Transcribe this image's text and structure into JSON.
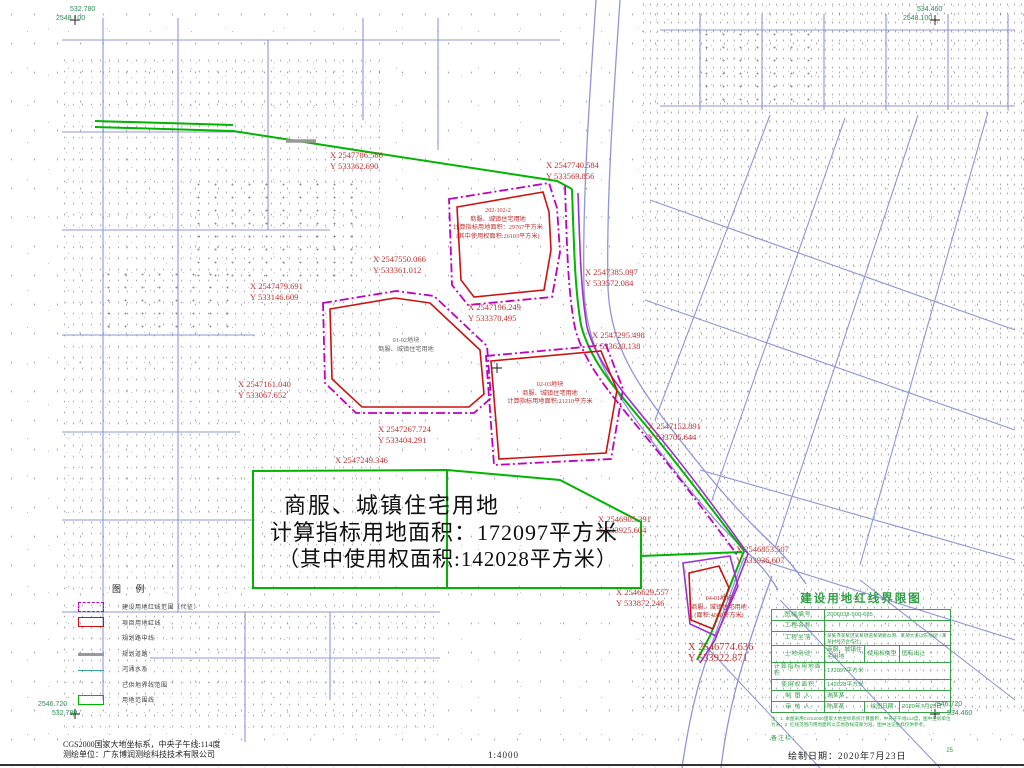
{
  "map": {
    "main_annotation": {
      "line1": "商服、城镇住宅用地",
      "line2": "计算指标用地面积：172097平方米",
      "line3": "（其中使用权面积:142028平方米）"
    },
    "corner_coords": {
      "top_left": {
        "line1": "532.780",
        "line2": "2548.100"
      },
      "top_right": {
        "line1": "534.460",
        "line2": "2548.100"
      },
      "bottom_left": {
        "line1": "2546.720",
        "line2": "532.780"
      },
      "bottom_right": {
        "line1": "2546.720",
        "line2": "534.460"
      }
    },
    "coordinate_labels": [
      {
        "x": 330,
        "y": 150,
        "l1": "X 2547786.566",
        "l2": "Y 533362.690"
      },
      {
        "x": 546,
        "y": 160,
        "l1": "X 2547740.584",
        "l2": "Y 533569.856"
      },
      {
        "x": 373,
        "y": 254,
        "l1": "X 2547550.066",
        "l2": "Y 533361.012"
      },
      {
        "x": 250,
        "y": 281,
        "l1": "X 2547479.691",
        "l2": "Y 533146.609"
      },
      {
        "x": 468,
        "y": 302,
        "l1": "X 2547196.249",
        "l2": "Y 533370.495"
      },
      {
        "x": 585,
        "y": 267,
        "l1": "X 2547385.097",
        "l2": "Y 533572.084"
      },
      {
        "x": 592,
        "y": 330,
        "l1": "X 2547295.498",
        "l2": "Y 533620.138"
      },
      {
        "x": 238,
        "y": 379,
        "l1": "X 2547161.040",
        "l2": "Y 533067.652"
      },
      {
        "x": 378,
        "y": 424,
        "l1": "X 2547267.724",
        "l2": "Y 533404.291"
      },
      {
        "x": 335,
        "y": 455,
        "l1": "X 2547249.346"
      },
      {
        "x": 648,
        "y": 421,
        "l1": "X 2547152.891",
        "l2": "Y 533705.644"
      },
      {
        "x": 598,
        "y": 514,
        "l1": "X 2546905.391",
        "l2": "Y 533925.604"
      },
      {
        "x": 736,
        "y": 544,
        "l1": "X 2546853.507",
        "l2": "Y 533936.607"
      },
      {
        "x": 616,
        "y": 587,
        "l1": "X 2546629.557",
        "l2": "Y 533872.246"
      },
      {
        "x": 688,
        "y": 642,
        "l1": "X 2546774.636",
        "l2": "Y 533922.871",
        "size": 10.5
      }
    ],
    "parcel_texts": [
      {
        "x": 436,
        "y": 207,
        "w": 124,
        "lines": [
          "202-102-2",
          "商服、城镇住宅用地",
          "计算指标用地面积：29767平方米",
          "(其中使用权面积:26103平方米)"
        ]
      },
      {
        "x": 494,
        "y": 381,
        "w": 112,
        "lines": [
          "02-03地块",
          "商服、城镇住宅用地",
          "计算指标用地面积:21210平方米"
        ]
      },
      {
        "x": 360,
        "y": 337,
        "w": 92,
        "muted": true,
        "lines": [
          "01-02地块",
          "商服、城镇住宅用地"
        ]
      },
      {
        "x": 682,
        "y": 595,
        "w": 74,
        "lines": [
          "04-01地块",
          "商服、城镇住宅用地",
          "(面积:4060平方米)"
        ]
      }
    ]
  },
  "legend": {
    "title": "图 例",
    "items": [
      {
        "swatch": "magenta-dashed-rect",
        "label": "建设用地红线范围（代征）"
      },
      {
        "swatch": "red-rect",
        "label": "项目用地红线"
      },
      {
        "swatch": "none",
        "label": "规划路中线"
      },
      {
        "swatch": "gray-line",
        "label": "规划道路"
      },
      {
        "swatch": "teal-line",
        "label": "河涌水系"
      },
      {
        "swatch": "none",
        "label": "已供地界线范围"
      },
      {
        "swatch": "green-rect",
        "label": "用地范围线"
      }
    ]
  },
  "title_block": {
    "title": "建设用地红线界限图",
    "rows": [
      {
        "label": "图幅编号",
        "value": "2006038-500-685"
      },
      {
        "label": "工程名称",
        "value": ""
      },
      {
        "label": "工程坐落",
        "value": "某某市某某区某某街道某某路以南、某某大道以东地段（某某村经济合作社）"
      },
      {
        "label": "土地用途",
        "value": "商服、城镇住宅用地",
        "label2": "使用权类型",
        "value2": "国有出让"
      },
      {
        "label": "计算指标用地面积",
        "value": "172097平方米"
      },
      {
        "label": "使用权面积",
        "value": "142028平方米"
      },
      {
        "label": "制 图 人",
        "value": "谢某某"
      },
      {
        "label": "审 核 人",
        "value": "陈某某",
        "label2": "绘图日期",
        "value2": "2020年7月23日"
      }
    ],
    "notes": "注：1. 本图采用CGS2000国家大地坐标系统计算面积，中央子午线114度，图中坐标单位为米；2. 红线范围内用地面积以实地放样成果为准，图中注记坐标仅供参考。",
    "remark_label": "备注栏：",
    "page_no": "25"
  },
  "footer": {
    "coord_note_line1": "CGS2000国家大地坐标系，中央子午线:114度",
    "coord_note_line2": "测绘单位：广东博润测绘科技技术有限公司",
    "scale": "1:4000",
    "draw_date": "绘制日期：2020年7月23日"
  },
  "colors": {
    "boundary_green": "#00b400",
    "parcel_red": "#cc1111",
    "redline_magenta": "#c000c0",
    "purple_line": "#9b30d0",
    "road_blue": "#9095d8",
    "coord_text_red": "#c03030",
    "titleblock_green": "#2f9e44",
    "corner_text_green": "#2e8b57",
    "gray_road": "#999999",
    "teal_water": "#3aa6a0"
  }
}
